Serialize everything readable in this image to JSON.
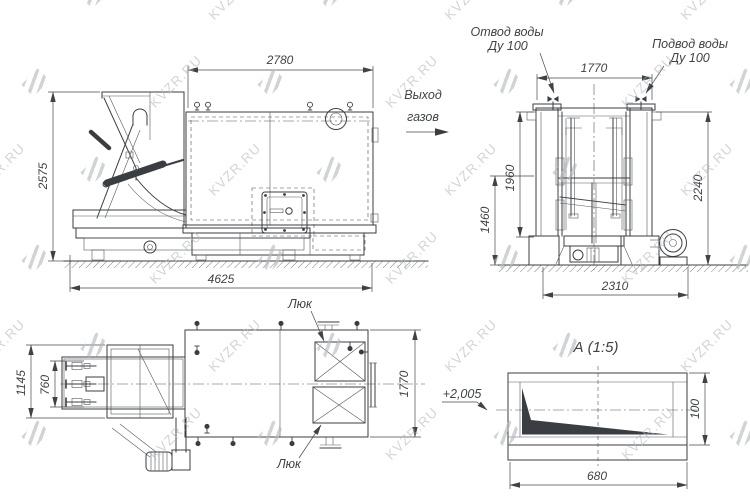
{
  "watermark": {
    "text": "KVZR.RU"
  },
  "side_view": {
    "dim_top_width": "2780",
    "dim_height": "2575",
    "dim_overall_length": "4625"
  },
  "gas_outlet": {
    "line1": "Выход",
    "line2": "газов"
  },
  "front_view": {
    "water_outlet_line1": "Отвод воды",
    "water_outlet_line2": "Ду 100",
    "water_inlet_line1": "Подвод воды",
    "water_inlet_line2": "Ду 100",
    "dim_top_width": "1770",
    "dim_left_outer": "1960",
    "dim_left_inner": "1460",
    "dim_right_height": "2240",
    "dim_bottom_width": "2310"
  },
  "plan_view": {
    "dim_feeder_overall": "1145",
    "dim_feeder_inner": "760",
    "dim_width": "1770",
    "hatch_label_top": "Люк",
    "hatch_label_bottom": "Люк"
  },
  "detail_a": {
    "title": "А (1:5)",
    "leader_label": "+2,005",
    "dim_length": "680",
    "dim_height": "100"
  }
}
